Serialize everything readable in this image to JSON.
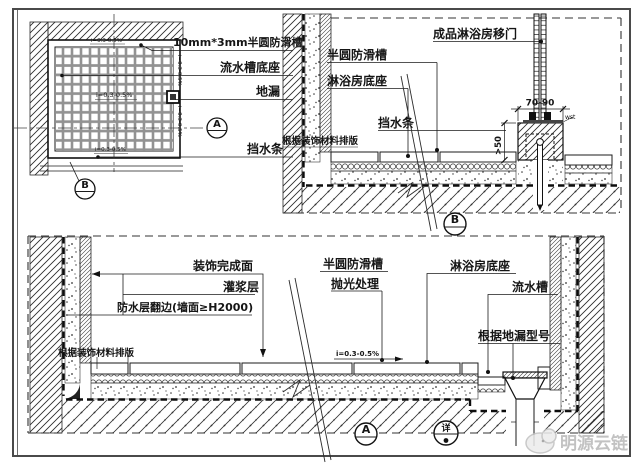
{
  "drawing": {
    "plan": {
      "slope_label": "i=0.3-0.5%",
      "callout_groove": "10mm*3mm半圆防滑槽",
      "callout_channel_base": "流水槽底座",
      "callout_drain": "地漏",
      "callout_waterstop": "挡水条",
      "marker_a": "A",
      "marker_b": "B"
    },
    "section_b": {
      "callout_door": "成品淋浴房移门",
      "callout_groove": "半圆防滑槽",
      "callout_base": "淋浴房底座",
      "callout_waterstop": "挡水条",
      "callout_layout": "根据装饰材料排版",
      "dim_width": "70-90",
      "dim_height": ">50",
      "dim_small": "wst",
      "marker": "B"
    },
    "section_a": {
      "callout_finish": "装饰完成面",
      "callout_grout": "灌浆层",
      "callout_waterproof": "防水层翻边(墙面≥H2000)",
      "callout_layout": "根据装饰材料排版",
      "callout_groove": "半圆防滑槽",
      "callout_polish": "抛光处理",
      "callout_base": "淋浴房底座",
      "callout_channel": "流水槽",
      "callout_drain_model": "根据地漏型号",
      "slope_label": "i=0.3-0.5%",
      "marker": "A",
      "marker_detail": "详"
    },
    "watermark": {
      "text": "明源云链"
    },
    "colors": {
      "line": "#1b1b1b",
      "grate_fill": "#929292",
      "watermark": "#ababab"
    }
  }
}
